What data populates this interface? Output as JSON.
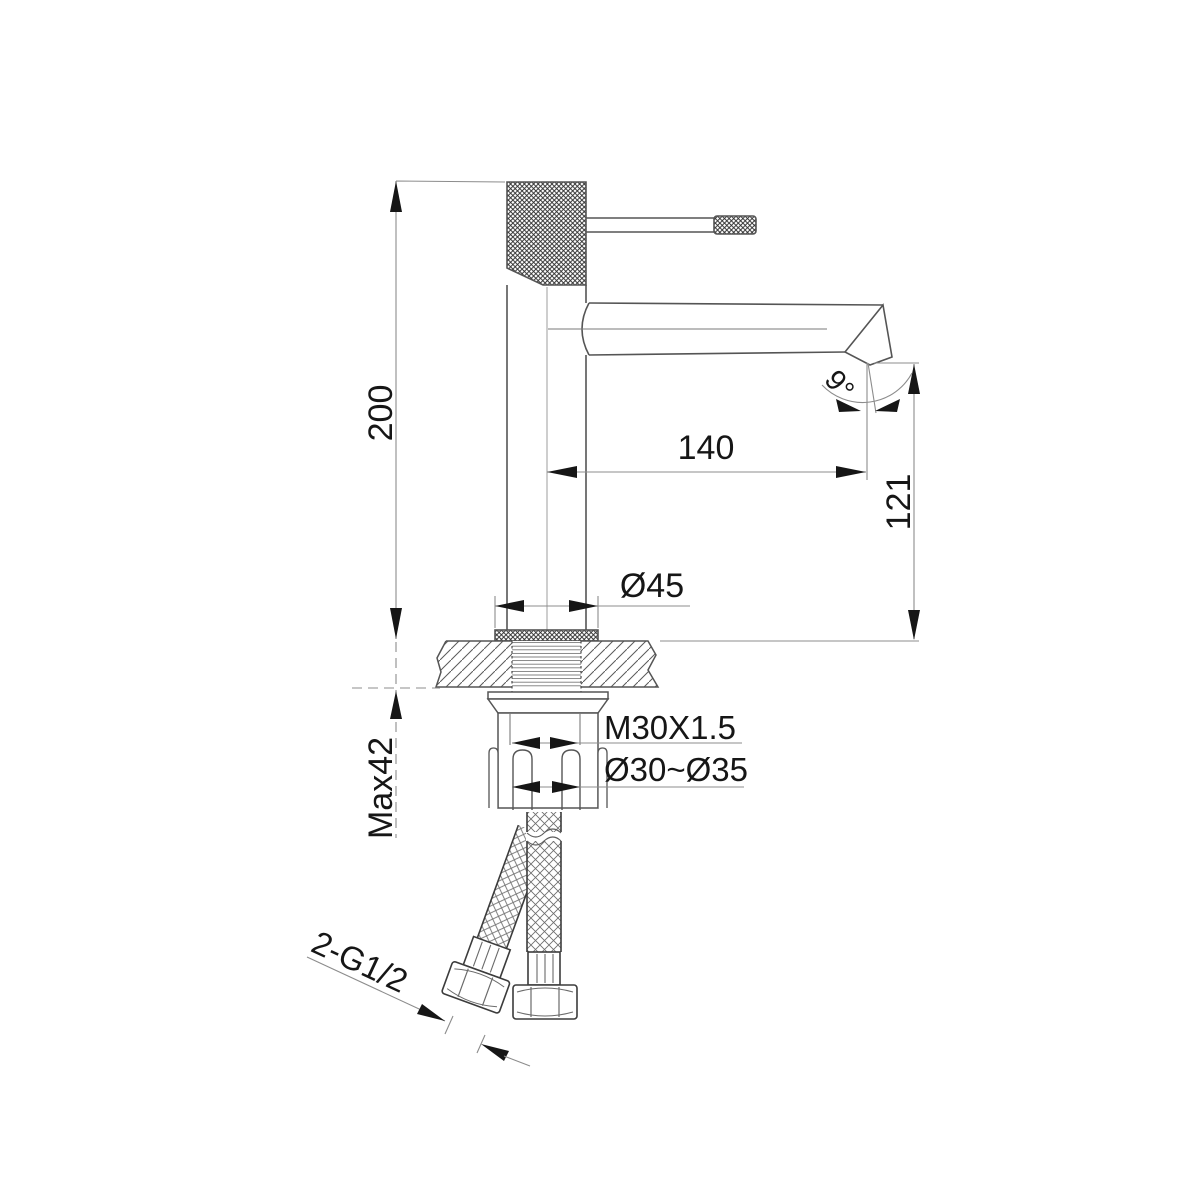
{
  "page": {
    "background": "#ffffff"
  },
  "drawing": {
    "subject": "single-lever basin faucet side-view installation dimension drawing",
    "units": "mm",
    "colors": {
      "object_line": "#555555",
      "dimension_line": "#8c8c8c",
      "center_line": "#9e9e9e",
      "arrow_and_text": "#161616",
      "background": "#ffffff"
    },
    "dimensions": {
      "overall_height": "200",
      "spout_reach": "140",
      "outlet_height": "121",
      "outlet_angle": "9°",
      "base_diameter": "Ø45",
      "mounting_thread": "M30X1.5",
      "mounting_hole_range": "Ø30~Ø35",
      "max_deck_thickness": "Max42",
      "inlet_connection": "2-G1/2"
    }
  }
}
